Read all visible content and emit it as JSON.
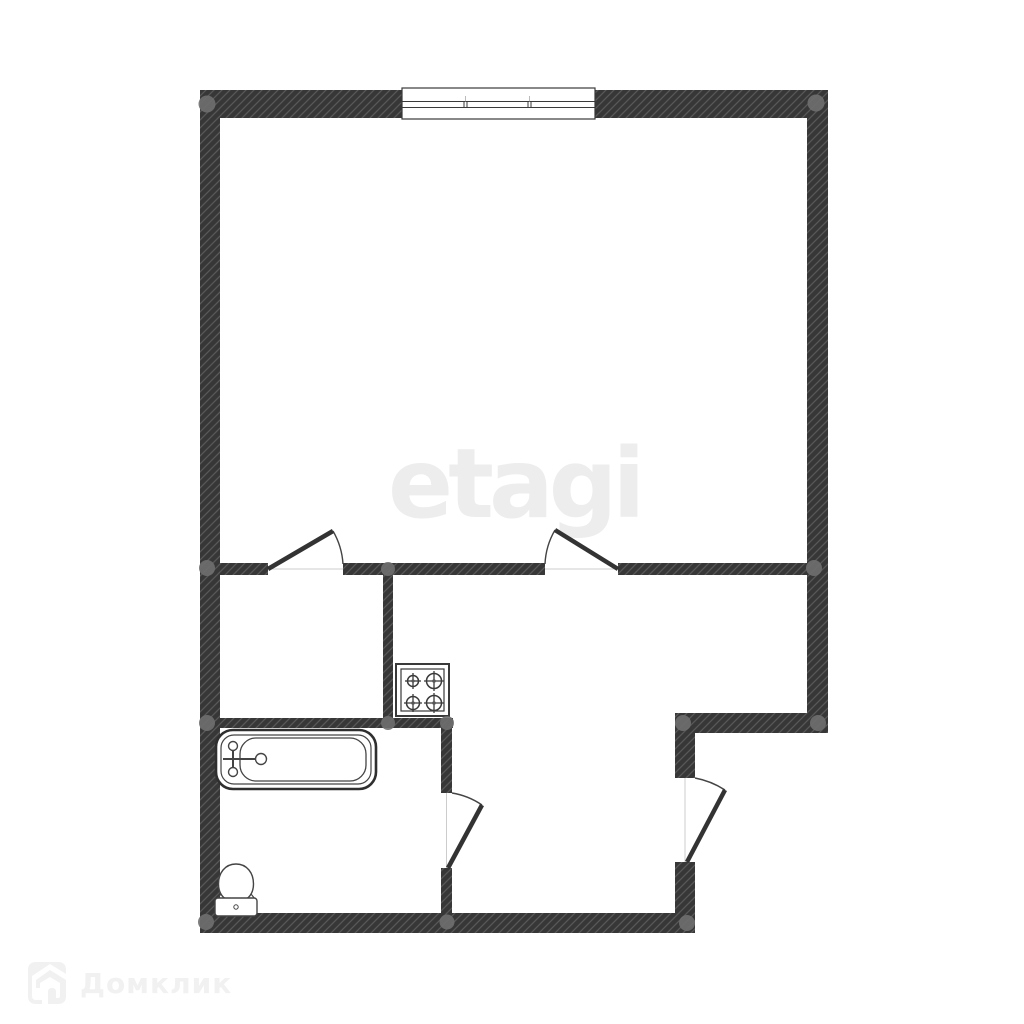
{
  "image_type": "apartment-floor-plan",
  "watermarks": {
    "center": "etagi",
    "bottom_left": "Домклик"
  },
  "colors": {
    "background": "#ffffff",
    "wall_fill": "#373737",
    "wall_hatch_line": "#9a9a9a",
    "junction_dot": "#6f6f6f",
    "fixture_line": "#3a3a3a",
    "threshold_line": "#cccccc",
    "watermark_center": "#ededed",
    "watermark_bottom_left": "#f1f1f1"
  },
  "floorplan": {
    "window_count": 1,
    "door_count": 4,
    "doors": [
      "closet-door",
      "kitchen-door",
      "bathroom-door",
      "entry-door"
    ],
    "fixtures": [
      "bathtub",
      "toilet",
      "stove-4-burner"
    ],
    "junction_dot_count": 13
  }
}
